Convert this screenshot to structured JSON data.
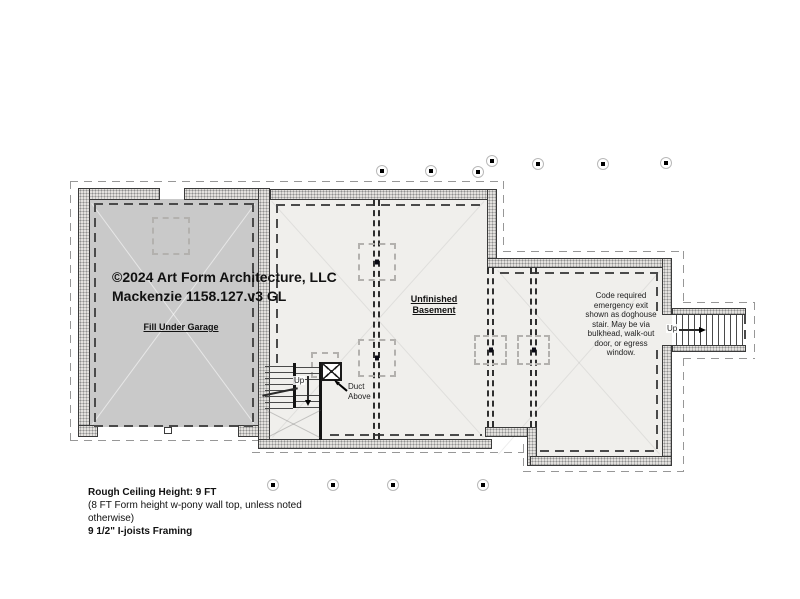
{
  "title_block": {
    "copyright": "©2024 Art Form Architecture, LLC",
    "project": "Mackenzie 1158.127.v3 GL"
  },
  "labels": {
    "garage": "Fill Under Garage",
    "basement": [
      "Unfinished",
      "Basement"
    ]
  },
  "egress_note": [
    "Code required",
    "emergency exit",
    "shown as doghouse",
    "stair. May be via",
    "bulkhead, walk-out",
    "door, or egress",
    "window."
  ],
  "stairs": {
    "interior_up": "Up",
    "exterior_up": "Up",
    "duct": [
      "Duct",
      "Above"
    ]
  },
  "notes": [
    "Rough Ceiling Height: 9 FT",
    "(8 FT Form height w-pony wall top, unless noted",
    "otherwise)",
    "9 1/2\" I-joists Framing"
  ],
  "colors": {
    "garage_fill": "#c9c9c9",
    "basement_fill": "#f0efec",
    "wall_stipple_base": "#e3e1de",
    "wall_edge": "#3a3a3a",
    "dash_dark": "#4a4a4a",
    "dash_light": "#979797",
    "pad_dash": "#b3b1ae"
  }
}
